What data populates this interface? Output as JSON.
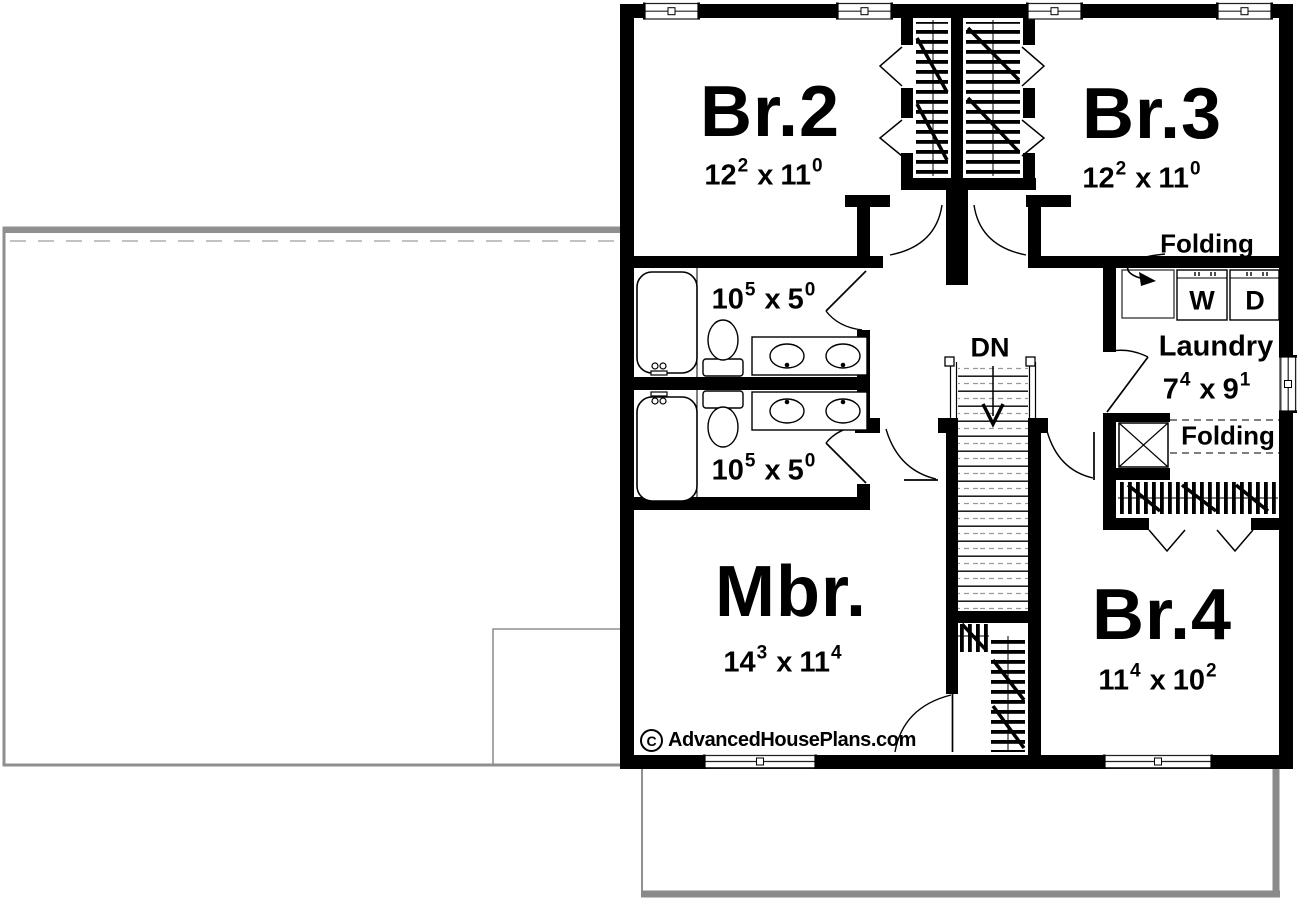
{
  "rooms": {
    "br2": {
      "label": "Br.2",
      "dim": {
        "a": "12",
        "asup": "2",
        "b": "11",
        "bsup": "0"
      }
    },
    "br3": {
      "label": "Br.3",
      "dim": {
        "a": "12",
        "asup": "2",
        "b": "11",
        "bsup": "0"
      }
    },
    "mbr": {
      "label": "Mbr.",
      "dim": {
        "a": "14",
        "asup": "3",
        "b": "11",
        "bsup": "4"
      }
    },
    "br4": {
      "label": "Br.4",
      "dim": {
        "a": "11",
        "asup": "4",
        "b": "10",
        "bsup": "2"
      }
    },
    "laundry": {
      "label": "Laundry",
      "dim": {
        "a": "7",
        "asup": "4",
        "b": "9",
        "bsup": "1"
      }
    },
    "bath_upper": {
      "dim": {
        "a": "10",
        "asup": "5",
        "b": "5",
        "bsup": "0"
      }
    },
    "bath_lower": {
      "dim": {
        "a": "10",
        "asup": "5",
        "b": "5",
        "bsup": "0"
      }
    }
  },
  "labels": {
    "folding_upper": "Folding",
    "folding_lower": "Folding",
    "washer": "W",
    "dryer": "D",
    "stairs_down": "DN",
    "dim_sep": "x"
  },
  "watermark": {
    "symbol": "C",
    "text": "AdvancedHousePlans.com"
  },
  "colors": {
    "wall": "#000000",
    "roof_outline": "#8f8f8f",
    "shadow": "#8a8a8a",
    "background": "#ffffff"
  }
}
